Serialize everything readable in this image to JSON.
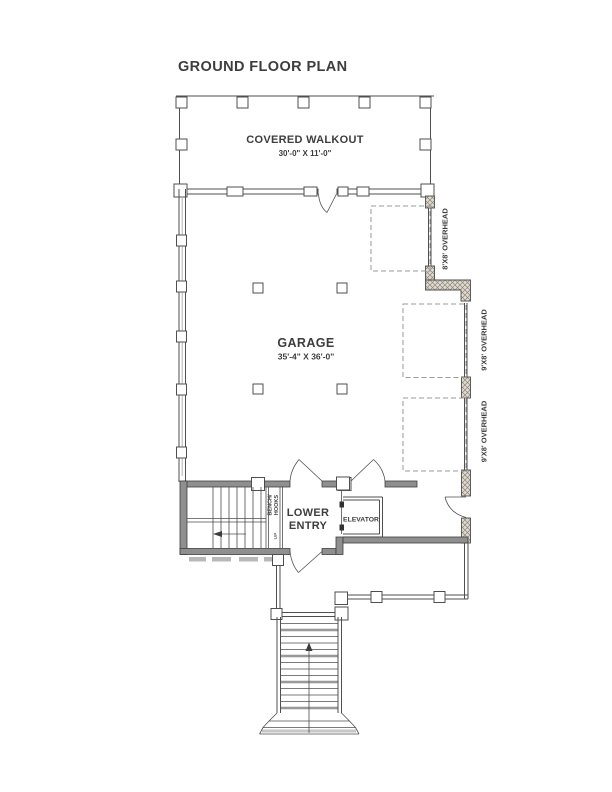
{
  "page": {
    "title": "GROUND FLOOR PLAN"
  },
  "rooms": {
    "covered_walkout": {
      "name": "COVERED WALKOUT",
      "dimensions": "30'-0\" X 11'-0\""
    },
    "garage": {
      "name": "GARAGE",
      "dimensions": "35'-4\" X 36'-0\""
    },
    "lower_entry": {
      "line1": "LOWER",
      "line2": "ENTRY"
    },
    "elevator": {
      "name": "ELEVATOR"
    }
  },
  "annotations": {
    "bench": {
      "line1": "BENCH/",
      "line2": "HOOKS"
    },
    "stair_up": "UP",
    "overhead_door_8x8": "8'X8' OVERHEAD",
    "overhead_door_9x8_upper": "9'X8' OVERHEAD",
    "overhead_door_9x8_lower": "9'X8' OVERHEAD"
  },
  "colors": {
    "background": "#ffffff",
    "line": "#4f4f4f",
    "wall_fill": "#8f8f8f",
    "text": "#3d3d3d",
    "dashed_line": "#9a9a9a"
  }
}
